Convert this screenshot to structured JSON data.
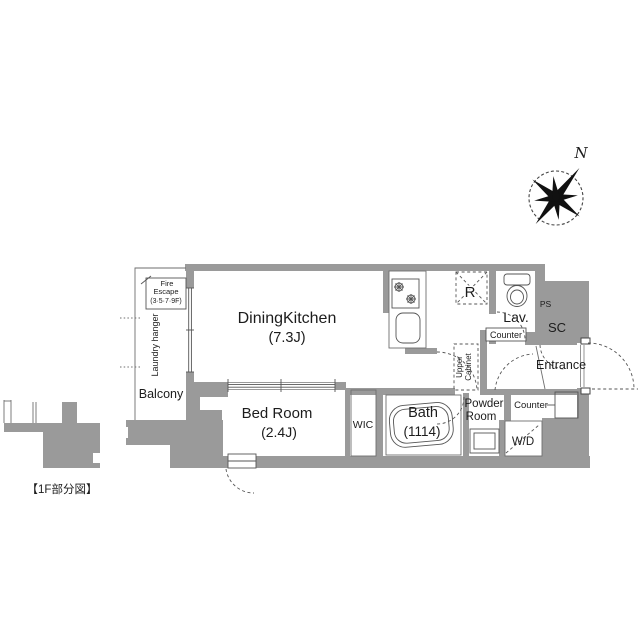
{
  "palette": {
    "wall": "#9a9a9a",
    "line": "#4a4a4a",
    "thin_line": "#6e6e6e",
    "dash": "#555555",
    "text": "#1c1c1c",
    "background": "#ffffff"
  },
  "caption": "【1F部分図】",
  "compass": {
    "north_label": "N"
  },
  "rooms": {
    "dining_kitchen": {
      "name": "DiningKitchen",
      "size": "(7.3J)"
    },
    "bed_room": {
      "name": "Bed Room",
      "size": "(2.4J)"
    },
    "wic": {
      "name": "WIC"
    },
    "bath": {
      "name": "Bath",
      "size": "(1114)"
    },
    "powder_room": {
      "line1": "Powder",
      "line2": "Room"
    },
    "lavatory": {
      "name": "Lav."
    },
    "entrance": {
      "name": "Entrance"
    },
    "balcony": {
      "name": "Balcony"
    },
    "shoe_closet": {
      "name": "SC"
    },
    "pipe_space": {
      "name": "PS"
    },
    "refrigerator": {
      "name": "R"
    },
    "washer_dryer": {
      "name": "W/D"
    }
  },
  "fixtures": {
    "counter_lavatory": "Counter",
    "counter_entrance": "Counter",
    "upper_cabinet_line1": "Upper",
    "upper_cabinet_line2": "Cabinet",
    "laundry_hanger": "Laundry hanger",
    "fire_escape_line1": "Fire",
    "fire_escape_line2": "Escape",
    "fire_escape_line3": "(3·5·7·9F)"
  }
}
